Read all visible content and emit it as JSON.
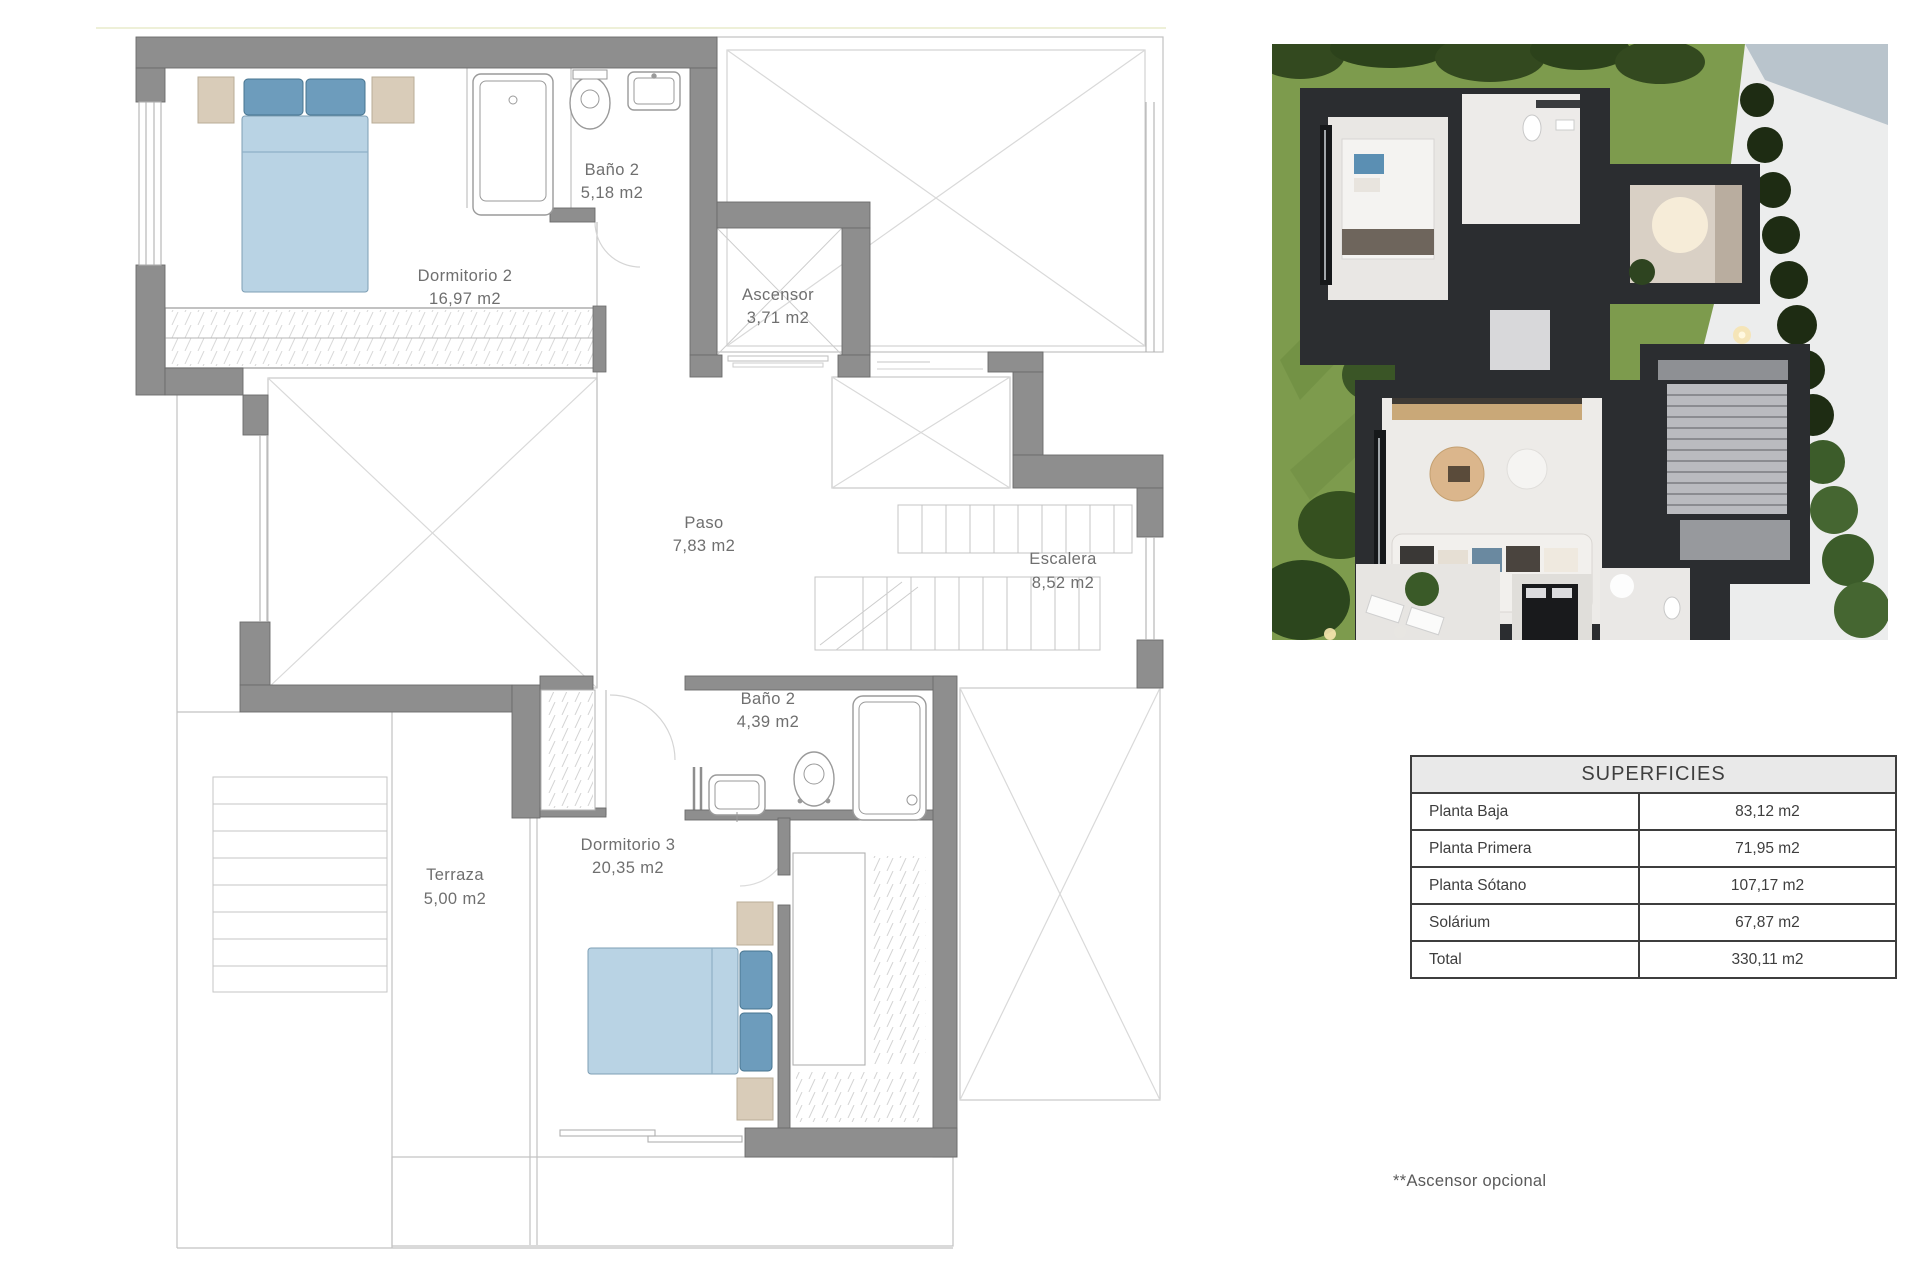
{
  "plan": {
    "rooms": [
      {
        "name": "Dormitorio 2",
        "area": "16,97 m2"
      },
      {
        "name": "Baño 2",
        "area": "5,18 m2"
      },
      {
        "name": "Ascensor",
        "area": "3,71 m2"
      },
      {
        "name": "Paso",
        "area": "7,83 m2"
      },
      {
        "name": "Escalera",
        "area": "8,52 m2"
      },
      {
        "name": "Baño 2",
        "area": "4,39 m2"
      },
      {
        "name": "Dormitorio 3",
        "area": "20,35 m2"
      },
      {
        "name": "Terraza",
        "area": "5,00 m2"
      }
    ]
  },
  "table": {
    "title": "SUPERFICIES",
    "rows": [
      {
        "label": "Planta Baja",
        "value": "83,12 m2"
      },
      {
        "label": "Planta Primera",
        "value": "71,95 m2"
      },
      {
        "label": "Planta Sótano",
        "value": "107,17 m2"
      },
      {
        "label": "Solárium",
        "value": "67,87 m2"
      },
      {
        "label": "Total",
        "value": "330,11 m2"
      }
    ]
  },
  "footnote": "**Ascensor opcional",
  "colors": {
    "wall_gray": "#8e8e8e",
    "line_gray": "#b9b9b9",
    "text_gray": "#6f6f6f",
    "bed_fill": "#b9d3e4",
    "bed_stroke": "#7e9fb5",
    "pillow_fill": "#6d9cbc",
    "pillow_stroke": "#47748f",
    "nightstand_fill": "#d9ccb9",
    "nightstand_stroke": "#b9ac97",
    "grass": "#7d9b4d",
    "house_dark": "#2b2d30",
    "table_header_bg": "#e9e9e9",
    "table_border": "#3d3d3d"
  }
}
